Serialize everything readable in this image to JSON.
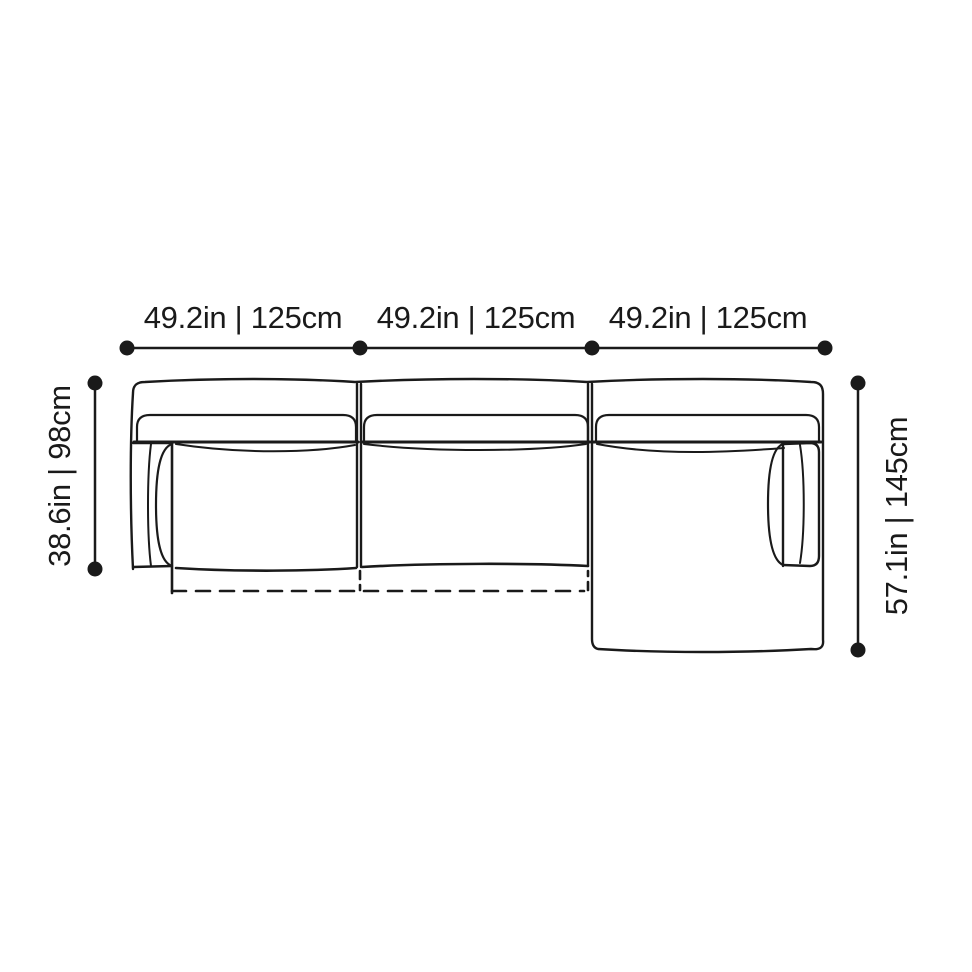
{
  "drawing": {
    "type": "sofa-top-view-dimension-diagram",
    "background": "#ffffff",
    "line_color": "#1a1a1a",
    "modules": [
      "seat-module-left",
      "seat-module-middle",
      "chaise-module-right"
    ]
  },
  "dimensions": {
    "top_labels": [
      "49.2in | 125cm",
      "49.2in | 125cm",
      "49.2in | 125cm"
    ],
    "left_label": "38.6in | 98cm",
    "right_label": "57.1in | 145cm"
  }
}
